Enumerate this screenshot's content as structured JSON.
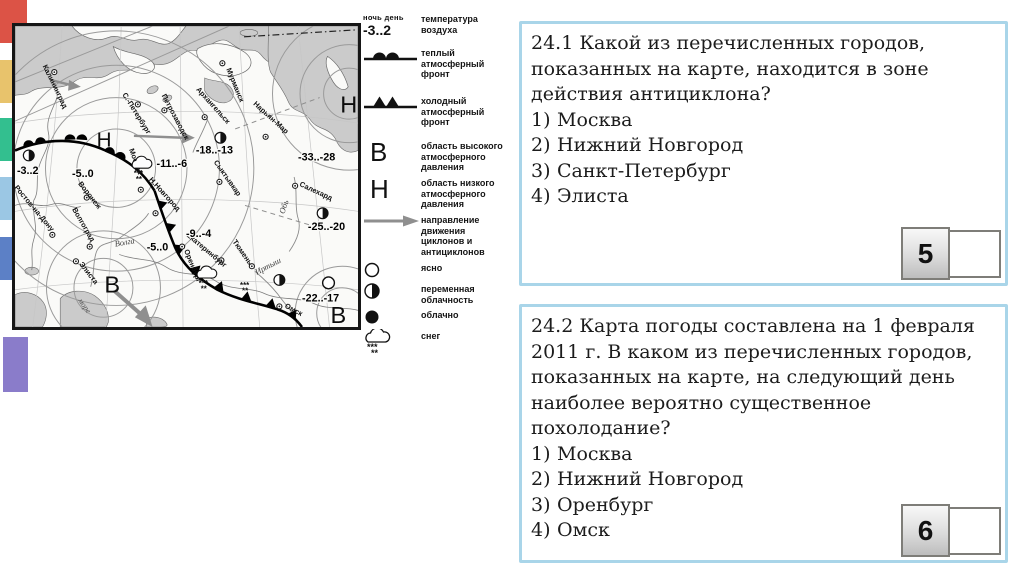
{
  "decor_squares": [
    {
      "color": "#dc5346",
      "x": 0,
      "y": 0,
      "w": 27,
      "h": 43
    },
    {
      "color": "#e8c36c",
      "x": 0,
      "y": 60,
      "w": 27,
      "h": 43
    },
    {
      "color": "#33bf8f",
      "x": 0,
      "y": 118,
      "w": 27,
      "h": 43
    },
    {
      "color": "#9bc7e4",
      "x": 0,
      "y": 177,
      "w": 27,
      "h": 43
    },
    {
      "color": "#5c80c6",
      "x": 0,
      "y": 237,
      "w": 27,
      "h": 43
    },
    {
      "color": "#8a7cca",
      "x": 3,
      "y": 337,
      "w": 25,
      "h": 55
    }
  ],
  "map": {
    "cities": [
      {
        "name": "Калининград",
        "dx": 52,
        "dy": 70,
        "lx": 40,
        "ly": 64,
        "rot": 64
      },
      {
        "name": "С.-Петербург",
        "dx": 137,
        "dy": 103,
        "lx": 121,
        "ly": 93,
        "rot": 58
      },
      {
        "name": "Петрозаводск",
        "dx": 164,
        "dy": 109,
        "lx": 161,
        "ly": 94,
        "rot": 62
      },
      {
        "name": "Мурманск",
        "dx": 223,
        "dy": 61,
        "lx": 227,
        "ly": 67,
        "rot": 68
      },
      {
        "name": "Архангельск",
        "dx": 205,
        "dy": 116,
        "lx": 196,
        "ly": 88,
        "rot": 48
      },
      {
        "name": "Нарьян-Мар",
        "dx": 267,
        "dy": 136,
        "lx": 254,
        "ly": 103,
        "rot": 42
      },
      {
        "name": "Сыктывкар",
        "dx": 220,
        "dy": 182,
        "lx": 214,
        "ly": 162,
        "rot": 55
      },
      {
        "name": "Москва",
        "dx": 140,
        "dy": 190,
        "lx": 128,
        "ly": 149,
        "rot": 70
      },
      {
        "name": "Н.Новгород",
        "dx": 155,
        "dy": 214,
        "lx": 148,
        "ly": 180,
        "rot": 48
      },
      {
        "name": "Воронеж",
        "dx": 85,
        "dy": 198,
        "lx": 76,
        "ly": 184,
        "rot": 52
      },
      {
        "name": "Ростов-на-Дону",
        "dx": 50,
        "dy": 236,
        "lx": 11,
        "ly": 188,
        "rot": 50
      },
      {
        "name": "Волгоград",
        "dx": 88,
        "dy": 248,
        "lx": 70,
        "ly": 210,
        "rot": 60
      },
      {
        "name": "Элиста",
        "dx": 74,
        "dy": 263,
        "lx": 77,
        "ly": 266,
        "rot": 52
      },
      {
        "name": "Салехард",
        "dx": 297,
        "dy": 186,
        "lx": 301,
        "ly": 186,
        "rot": 25
      },
      {
        "name": "Екатеринбург",
        "dx": 222,
        "dy": 262,
        "lx": 186,
        "ly": 237,
        "rot": 40
      },
      {
        "name": "Тюмень",
        "dx": 253,
        "dy": 268,
        "lx": 233,
        "ly": 243,
        "rot": 55
      },
      {
        "name": "Оренбург",
        "dx": 182,
        "dy": 248,
        "lx": 184,
        "ly": 252,
        "rot": 68
      },
      {
        "name": "Омск",
        "dx": 281,
        "dy": 309,
        "lx": 286,
        "ly": 310,
        "rot": 28
      }
    ],
    "temps": [
      {
        "t": "-3..2",
        "x": 14,
        "y": 174
      },
      {
        "t": "-5..0",
        "x": 70,
        "y": 177
      },
      {
        "t": "-11..-6",
        "x": 156,
        "y": 167
      },
      {
        "t": "-18..-13",
        "x": 196,
        "y": 153
      },
      {
        "t": "-33..-28",
        "x": 300,
        "y": 160
      },
      {
        "t": "-9..-4",
        "x": 186,
        "y": 238
      },
      {
        "t": "-5..0",
        "x": 146,
        "y": 252
      },
      {
        "t": "-25..-20",
        "x": 310,
        "y": 231
      },
      {
        "t": "-22..-17",
        "x": 304,
        "y": 304
      }
    ],
    "pressures": [
      {
        "t": "Н",
        "x": 95,
        "y": 146,
        "s": 21
      },
      {
        "t": "Н",
        "x": 343,
        "y": 111,
        "s": 24
      },
      {
        "t": "В",
        "x": 103,
        "y": 295,
        "s": 24
      },
      {
        "t": "В",
        "x": 333,
        "y": 326,
        "s": 24
      }
    ],
    "rivers": [
      {
        "name": "Волга",
        "x": 114,
        "y": 248,
        "rot": -10
      },
      {
        "name": "Обь",
        "x": 286,
        "y": 215,
        "rot": -72
      },
      {
        "name": "Иртыш",
        "x": 258,
        "y": 277,
        "rot": -28
      }
    ],
    "sea_label": {
      "text": "море",
      "x": 76,
      "y": 303,
      "rot": 55
    },
    "symbols": [
      {
        "type": "half",
        "x": 26,
        "y": 155
      },
      {
        "type": "half",
        "x": 221,
        "y": 137
      },
      {
        "type": "half",
        "x": 325,
        "y": 214
      },
      {
        "type": "half",
        "x": 281,
        "y": 282
      },
      {
        "type": "open",
        "x": 331,
        "y": 285
      },
      {
        "type": "snow",
        "x": 141,
        "y": 165
      },
      {
        "type": "snow",
        "x": 207,
        "y": 277
      },
      {
        "type": "stars",
        "x": 249,
        "y": 286
      }
    ]
  },
  "legend": {
    "rows": [
      {
        "type": "temp",
        "top": "ночь день",
        "val": "-3..2",
        "label": "температура\nвоздуха"
      },
      {
        "type": "warm",
        "label": "теплый\nатмосферный\nфронт"
      },
      {
        "type": "cold",
        "label": "холодный\nатмосферный\nфронт"
      },
      {
        "type": "letter",
        "letter": "В",
        "label": "область высокого\nатмосферного\nдавления"
      },
      {
        "type": "letter",
        "letter": "Н",
        "label": "область низкого\nатмосферного\nдавления"
      },
      {
        "type": "arrow",
        "label": "направление\nдвижения\nциклонов и\nантициклонов"
      },
      {
        "type": "open",
        "label": "ясно"
      },
      {
        "type": "half",
        "label": "переменная\nоблачность"
      },
      {
        "type": "dot",
        "label": "облачно"
      },
      {
        "type": "snow",
        "label": "снег"
      }
    ]
  },
  "questions": [
    {
      "number": "5",
      "lines": [
        "24.1 Какой из перечисленных городов,",
        "показанных на карте, находится в зоне",
        "действия антициклона?"
      ],
      "options": [
        {
          "num": "1)",
          "text": "Москва"
        },
        {
          "num": "2)",
          "text": "Нижний Новгород"
        },
        {
          "num": "3)",
          "text": "Санкт-Петербург"
        },
        {
          "num": "4)",
          "text": "Элиста"
        }
      ]
    },
    {
      "number": "6",
      "lines": [
        "24.2 Карта погоды составлена на 1 февраля",
        "2011 г. В каком из перечисленных городов,",
        "показанных на карте, на следующий день",
        "наиболее вероятно существенное",
        "похолодание?"
      ],
      "options": [
        {
          "num": "1)",
          "text": "Москва"
        },
        {
          "num": "2)",
          "text": "Нижний Новгород"
        },
        {
          "num": "3)",
          "text": "Оренбург"
        },
        {
          "num": "4)",
          "text": "Омск"
        }
      ]
    }
  ]
}
